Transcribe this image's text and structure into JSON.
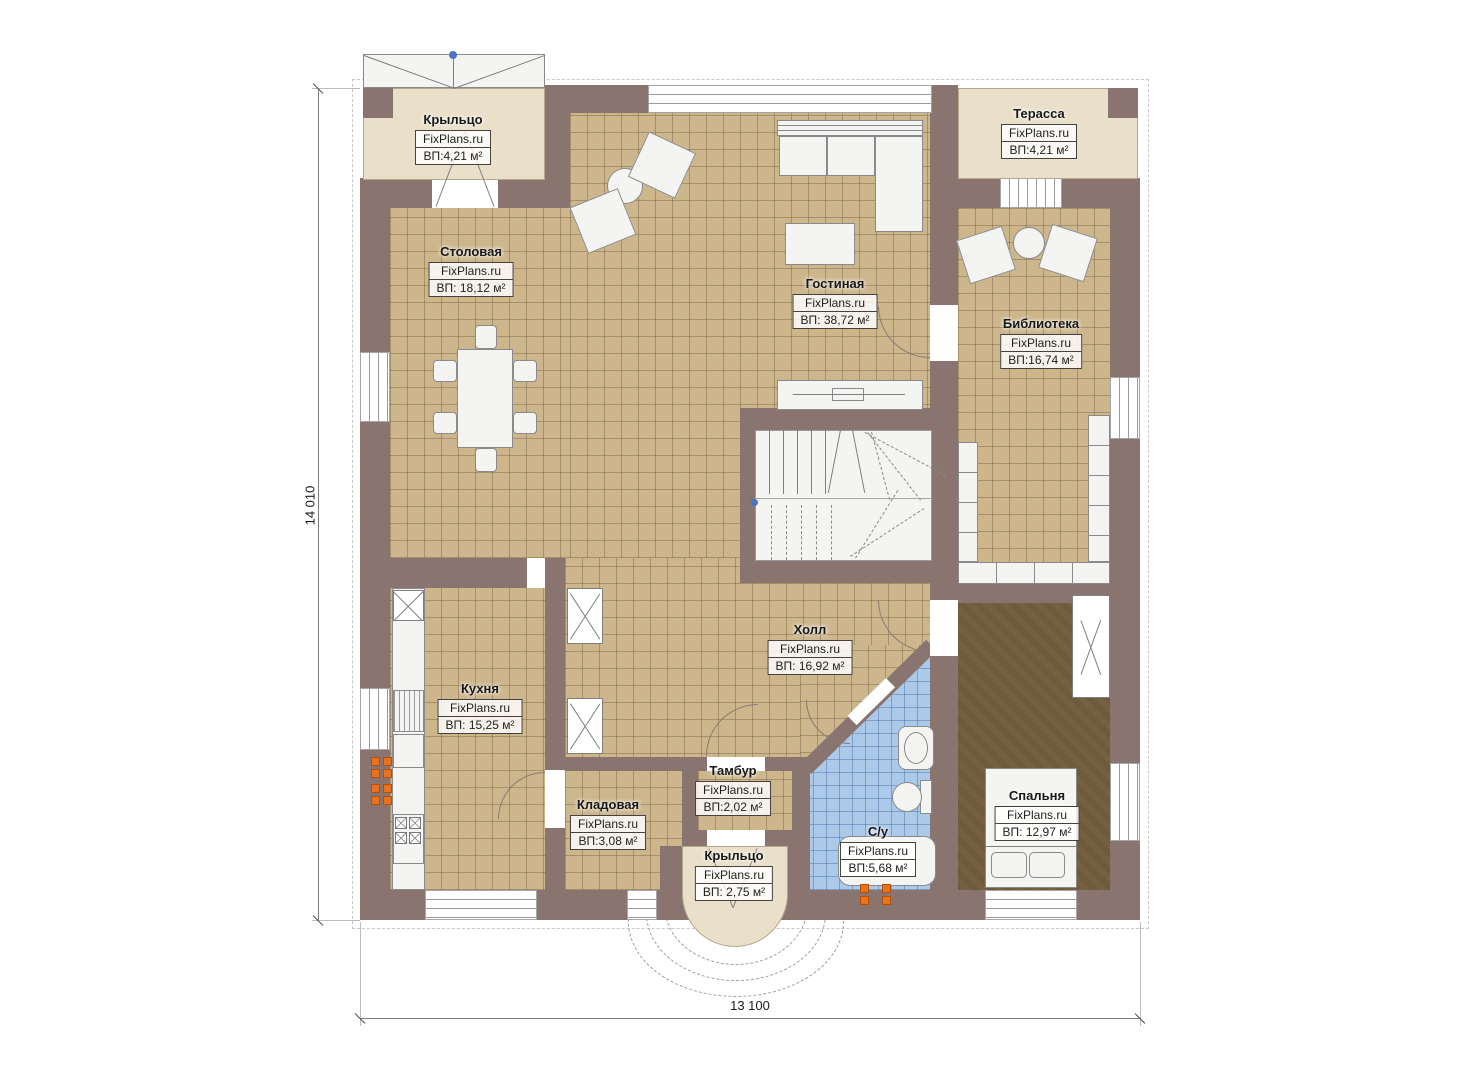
{
  "watermark": "FixPlans.ru",
  "dimensions": {
    "height": "14 010",
    "width": "13 100"
  },
  "rooms": {
    "porch_top": {
      "name": "Крыльцо",
      "area": "ВП:4,21 м²"
    },
    "dining": {
      "name": "Столовая",
      "area": "ВП: 18,12 м²"
    },
    "living": {
      "name": "Гостиная",
      "area": "ВП: 38,72 м²"
    },
    "terrace": {
      "name": "Терасса",
      "area": "ВП:4,21 м²"
    },
    "library": {
      "name": "Библиотека",
      "area": "ВП:16,74 м²"
    },
    "kitchen": {
      "name": "Кухня",
      "area": "ВП: 15,25 м²"
    },
    "hall": {
      "name": "Холл",
      "area": "ВП: 16,92 м²"
    },
    "pantry": {
      "name": "Кладовая",
      "area": "ВП:3,08 м²"
    },
    "tambour": {
      "name": "Тамбур",
      "area": "ВП:2,02 м²"
    },
    "bathroom": {
      "name": "С/у",
      "area": "ВП:5,68 м²"
    },
    "bedroom": {
      "name": "Спальня",
      "area": "ВП: 12,97 м²"
    },
    "porch_bottom": {
      "name": "Крыльцо",
      "area": "ВП: 2,75 м²"
    }
  },
  "colors": {
    "wall": "#8a7470",
    "tile_floor": "#cdb68c",
    "deck": "#eadfc9",
    "bath_tile": "#abc9e9",
    "bedroom_floor": "#75613f",
    "radiator_orange": "#e8731c",
    "marker_blue": "#4a74c9"
  }
}
